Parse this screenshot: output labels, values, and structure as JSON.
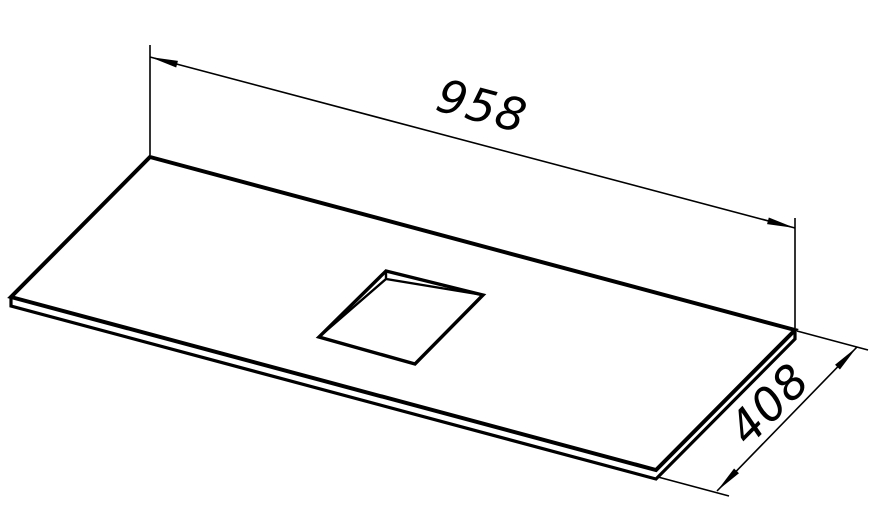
{
  "drawing": {
    "title": "panel-with-square-cutout-isometric",
    "dimensions": {
      "width_label": "958",
      "depth_label": "408"
    },
    "colors": {
      "line": "#000000",
      "background": "#ffffff"
    }
  }
}
